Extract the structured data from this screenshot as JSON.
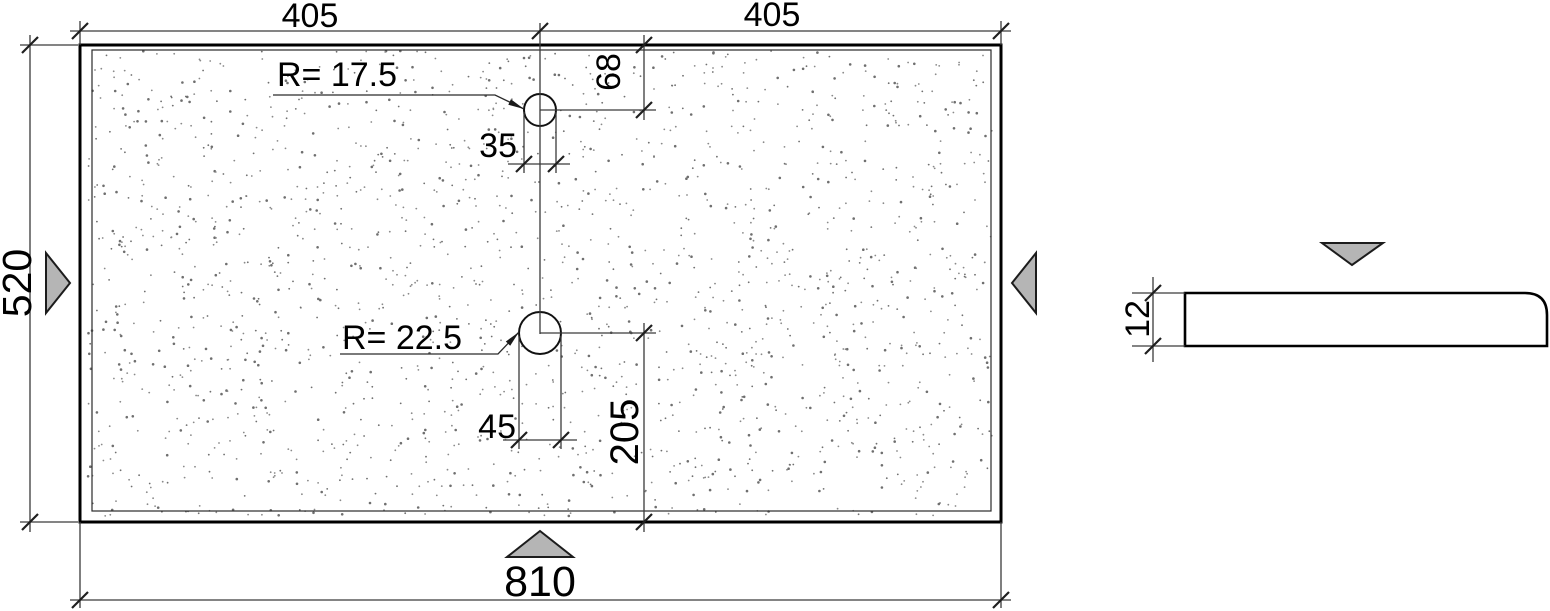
{
  "plan_view": {
    "dim_top_left": "405",
    "dim_top_right": "405",
    "dim_total_width": "810",
    "dim_total_height": "520",
    "hole_top": {
      "radius_label": "R= 17.5",
      "dim_center_from_top": "68",
      "dim_width": "35"
    },
    "hole_bottom": {
      "radius_label": "R= 22.5",
      "dim_width": "45",
      "dim_center_from_bottom": "205"
    }
  },
  "section_view": {
    "dim_thickness": "12"
  },
  "colors": {
    "triangle_fill": "#b5b5b5",
    "outline": "#000000",
    "dim_line": "#3a3a3a",
    "stipple_dot": "#8a8a8a"
  }
}
